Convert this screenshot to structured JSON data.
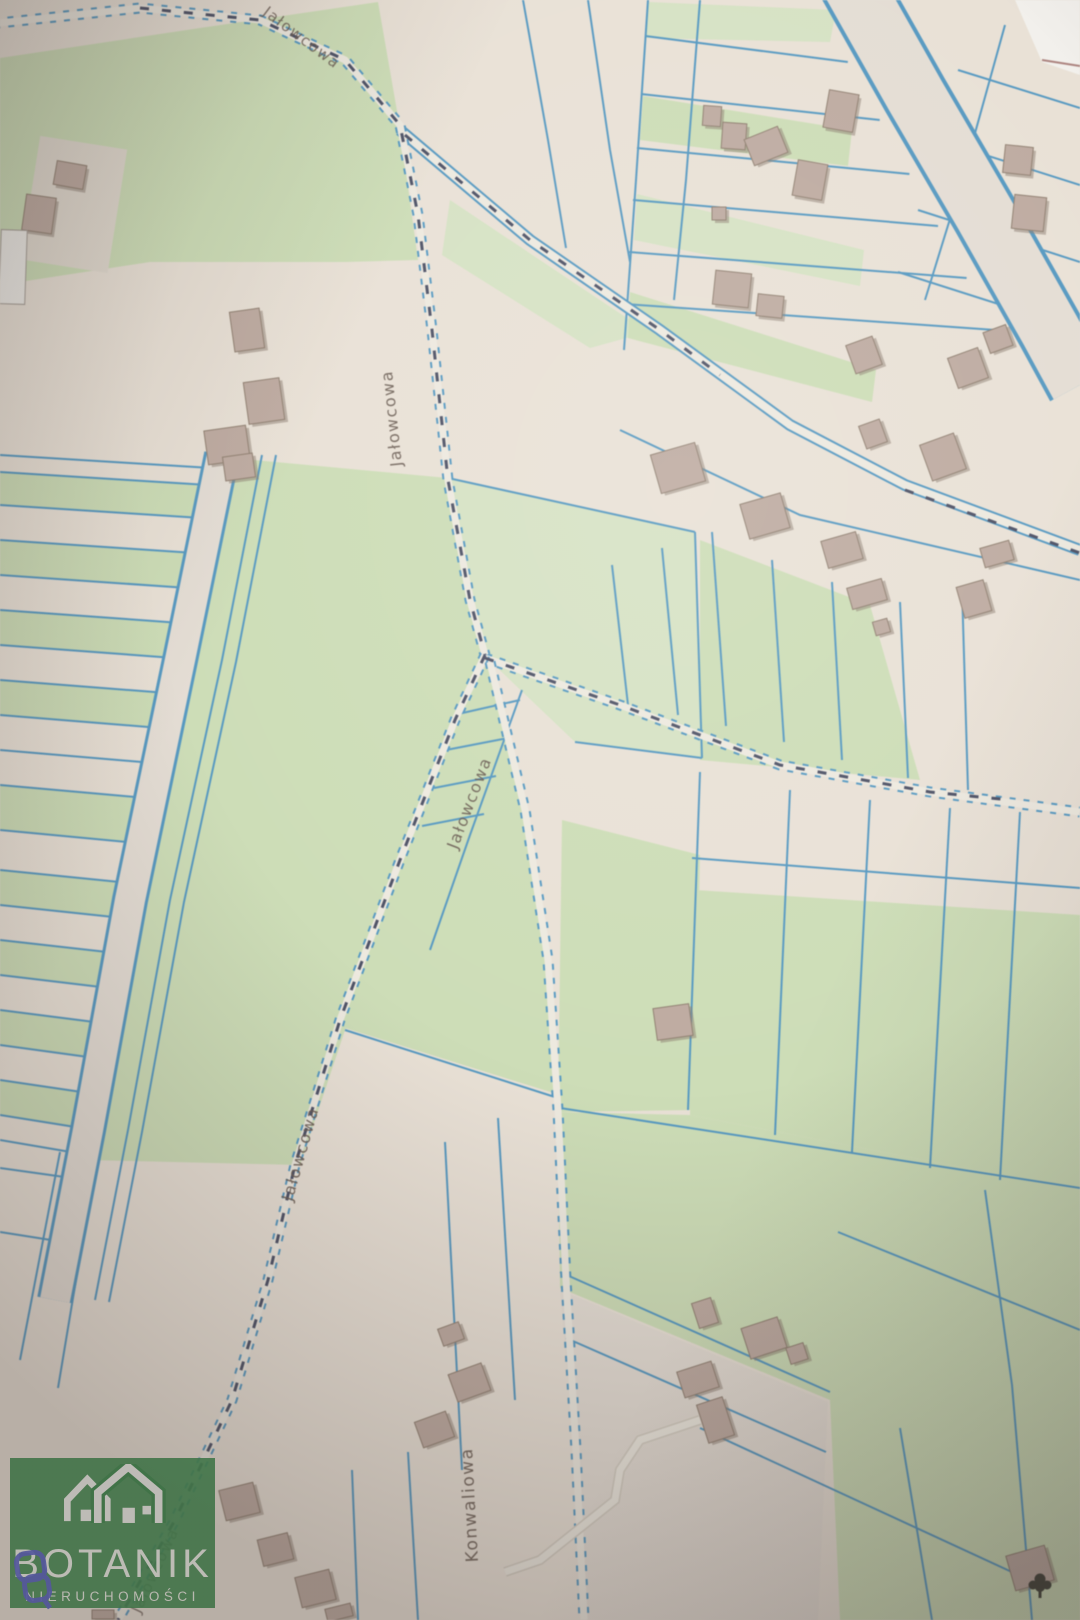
{
  "map": {
    "street_labels": [
      {
        "text": "Jałowcowa"
      },
      {
        "text": "Jałowcowa"
      },
      {
        "text": "Jałowcowa"
      },
      {
        "text": "Jałowcowa"
      },
      {
        "text": "Konwaliowa"
      },
      {
        "text": "Jałowcowa"
      }
    ],
    "icons": {
      "tree_symbol": "deciduous-tree-icon"
    },
    "colors": {
      "parcel_line": "#4e9ccb",
      "parcel_green": "#cfe2b5",
      "parcel_green_light": "#d8e7c3",
      "background_cream": "#e9e1d6",
      "yard_cream": "#e7dfd2",
      "road_fill": "#f2ede2",
      "building_fill": "#c3aca0",
      "building_edge": "#93806f",
      "building_shadow": "#8f7d70",
      "white_building": "#f3f1ea",
      "survey_dash": "#4b5068",
      "label_text": "#6b5b50",
      "tree_icon": "#3a3c31"
    }
  },
  "watermark": {
    "brand": "BOTANIK",
    "subtitle": "NIERUCHOMOŚCI",
    "logo_green": "#3e8b4f",
    "link_icon_blue": "#5a63c8"
  }
}
